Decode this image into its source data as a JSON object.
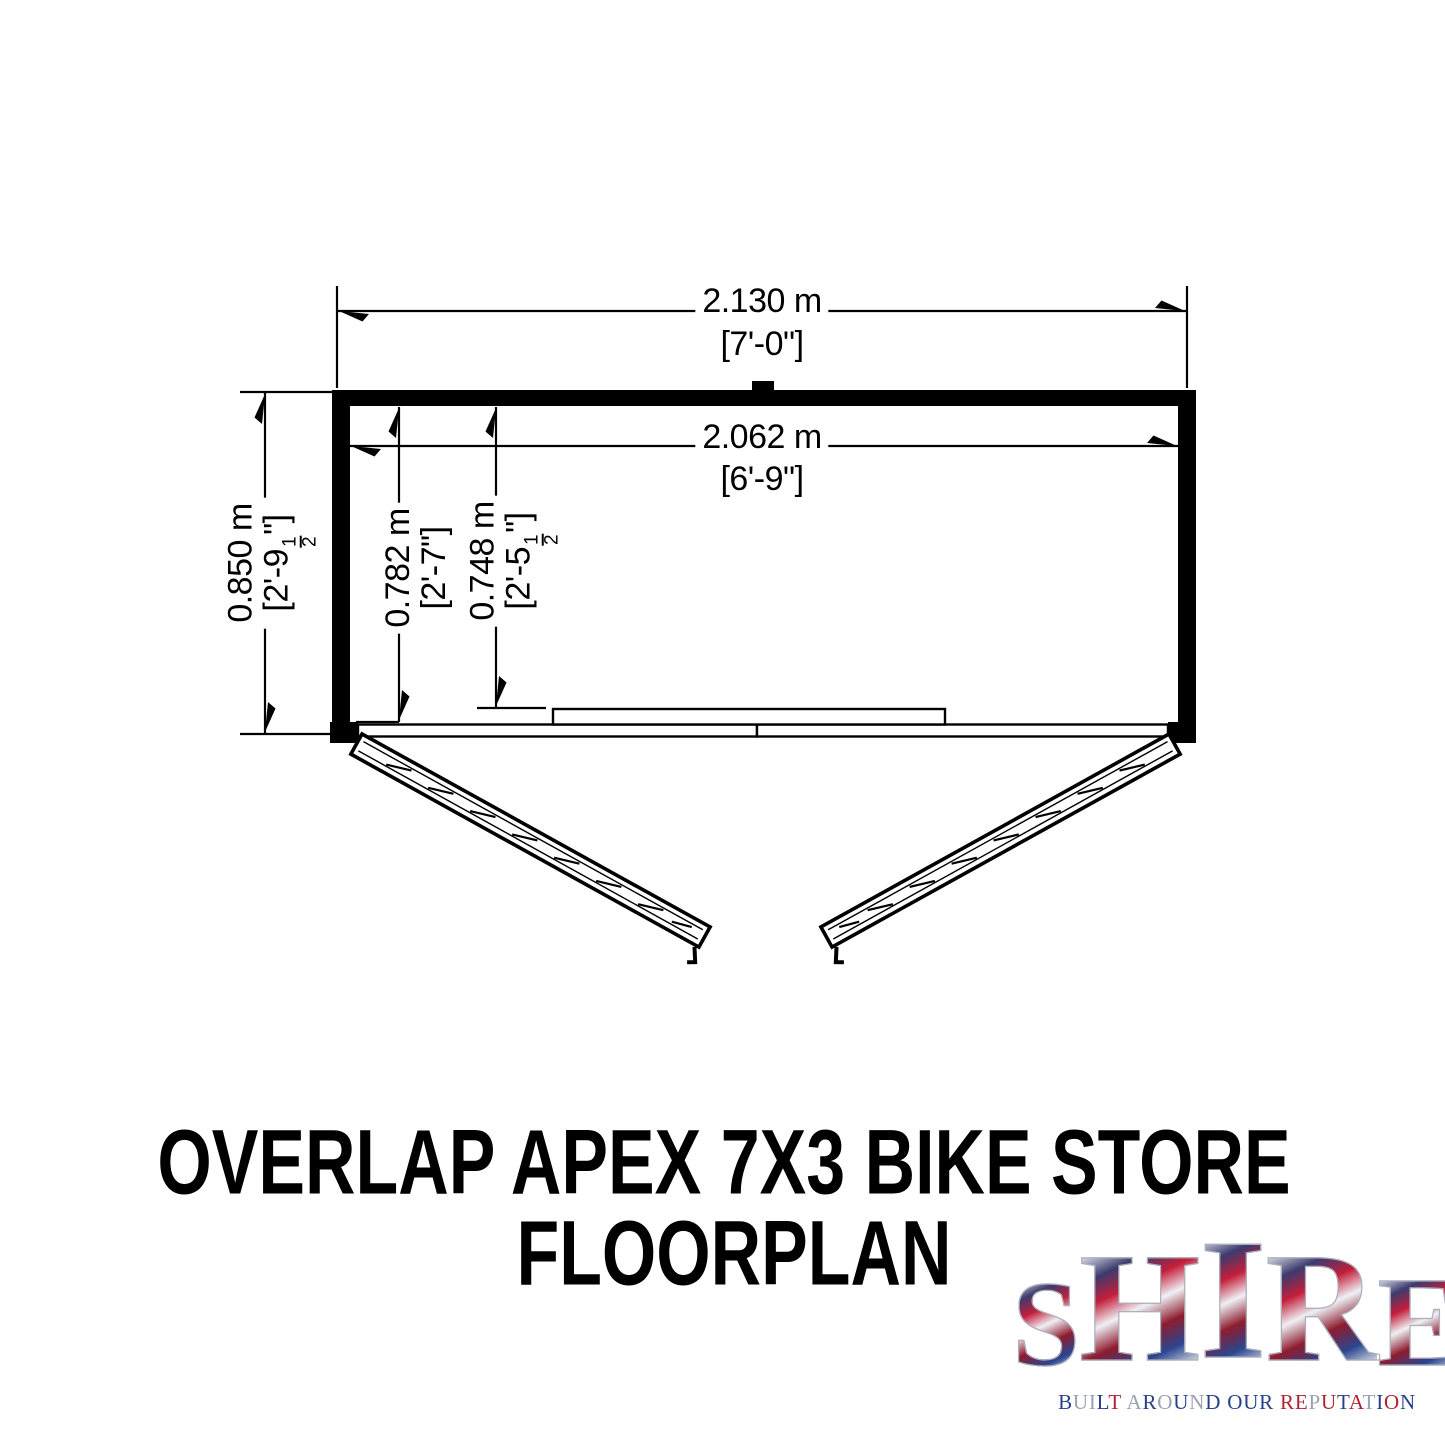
{
  "floorplan": {
    "dim_overall_width": {
      "metric": "2.130 m",
      "imperial": "[7'-0\"]"
    },
    "dim_internal_width": {
      "metric": "2.062 m",
      "imperial": "[6'-9\"]"
    },
    "dim_overall_depth": {
      "metric": "0.850 m",
      "imp_prefix": "[2'-9",
      "imp_num": "1",
      "imp_den": "2",
      "imp_suffix": "\"]"
    },
    "dim_internal_depth": {
      "metric": "0.782 m",
      "imperial": "[2'-7\"]"
    },
    "dim_door_depth": {
      "metric": "0.748 m",
      "imp_prefix": "[2'-5",
      "imp_num": "1",
      "imp_den": "2",
      "imp_suffix": "\"]"
    }
  },
  "title": {
    "line1": "OVERLAP APEX 7X3 BIKE STORE",
    "line2": "FLOORPLAN"
  },
  "logo": {
    "letters": [
      "S",
      "H",
      "I",
      "R",
      "E"
    ],
    "tagline": "BUILT AROUND OUR REPUTATION",
    "tagline_colors": [
      "#26408b",
      "#9aa2b0",
      "#9aa2b0",
      "#26408b",
      "#b22234",
      "#000000",
      "#9aa2b0",
      "#26408b",
      "#9aa2b0",
      "#26408b",
      "#9aa2b0",
      "#26408b",
      "#000000",
      "#26408b",
      "#26408b",
      "#26408b",
      "#000000",
      "#b22234",
      "#b22234",
      "#9aa2b0",
      "#b22234",
      "#26408b",
      "#b22234",
      "#9aa2b0",
      "#26408b",
      "#b22234",
      "#26408b"
    ],
    "brand_colors": {
      "red": "#b22234",
      "blue": "#26408b",
      "silver": "#9aa2b0"
    }
  }
}
